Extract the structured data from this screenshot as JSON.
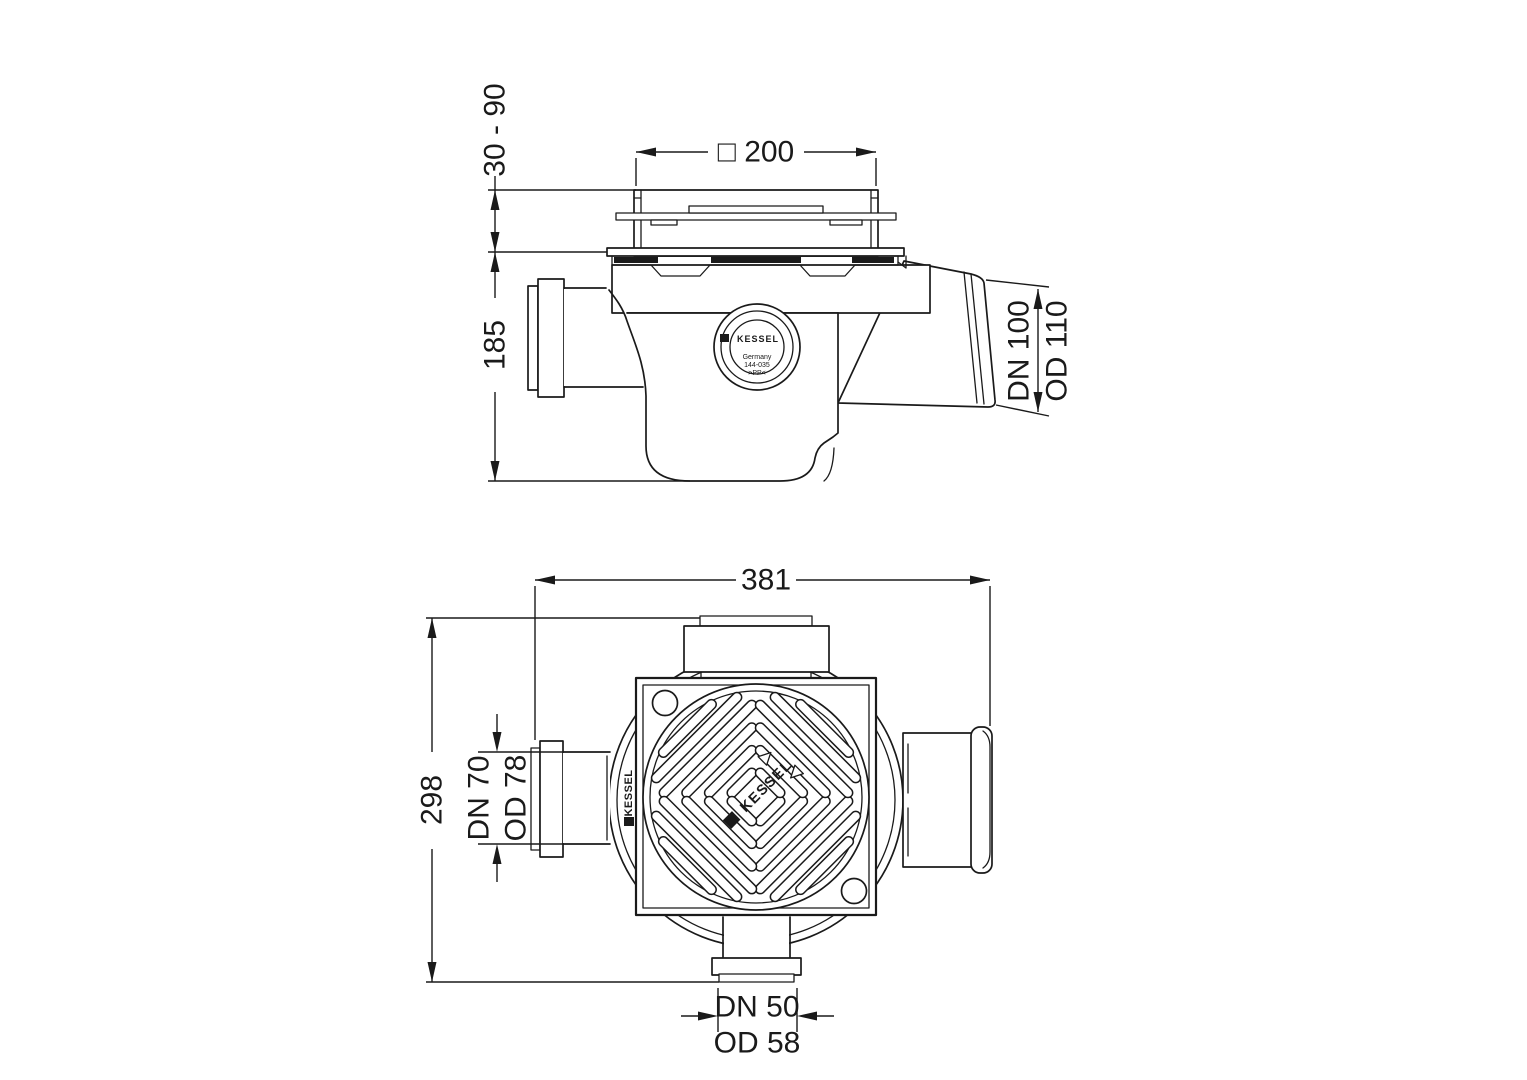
{
  "colors": {
    "line_color": "#1a1a1a",
    "background": "#ffffff"
  },
  "side_view": {
    "dims": {
      "height_adjustable": "30 - 90",
      "cover_width": "□ 200",
      "body_height": "185",
      "outlet_dn": "DN 100",
      "outlet_od": "OD 110"
    },
    "label": {
      "brand": "KESSEL",
      "country": "Germany",
      "mold_number": "144-035",
      "material": ">PP<"
    }
  },
  "plan_view": {
    "dims": {
      "overall_width": "381",
      "overall_depth": "298",
      "side_inlet_dn": "DN 70",
      "side_inlet_od": "OD 78",
      "bottom_inlet_dn": "DN 50",
      "bottom_inlet_od": "OD 58"
    },
    "grate_brand": "KESSEL",
    "rim_brand": "KESSEL"
  }
}
